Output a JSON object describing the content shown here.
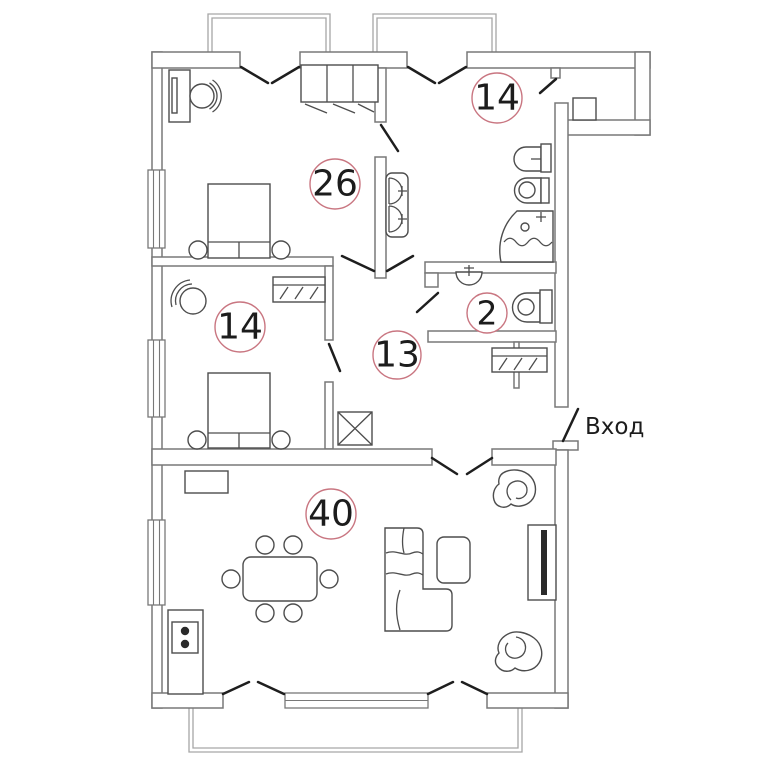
{
  "title": "Apartment floor plan",
  "entrance_label": "Вход",
  "rooms": [
    {
      "name": "bedroom-1",
      "area_label": "26"
    },
    {
      "name": "bathroom",
      "area_label": "14"
    },
    {
      "name": "bedroom-2",
      "area_label": "14"
    },
    {
      "name": "wc",
      "area_label": "2"
    },
    {
      "name": "hallway",
      "area_label": "13"
    },
    {
      "name": "living-room",
      "area_label": "40"
    }
  ],
  "colors": {
    "wall": "#787878",
    "furniture": "#4d4d4d",
    "door_swing": "#1e1e1e",
    "railing": "#a6a6a6",
    "room_circle": "#c97681",
    "text": "#1c1c1c",
    "background": "#ffffff"
  }
}
